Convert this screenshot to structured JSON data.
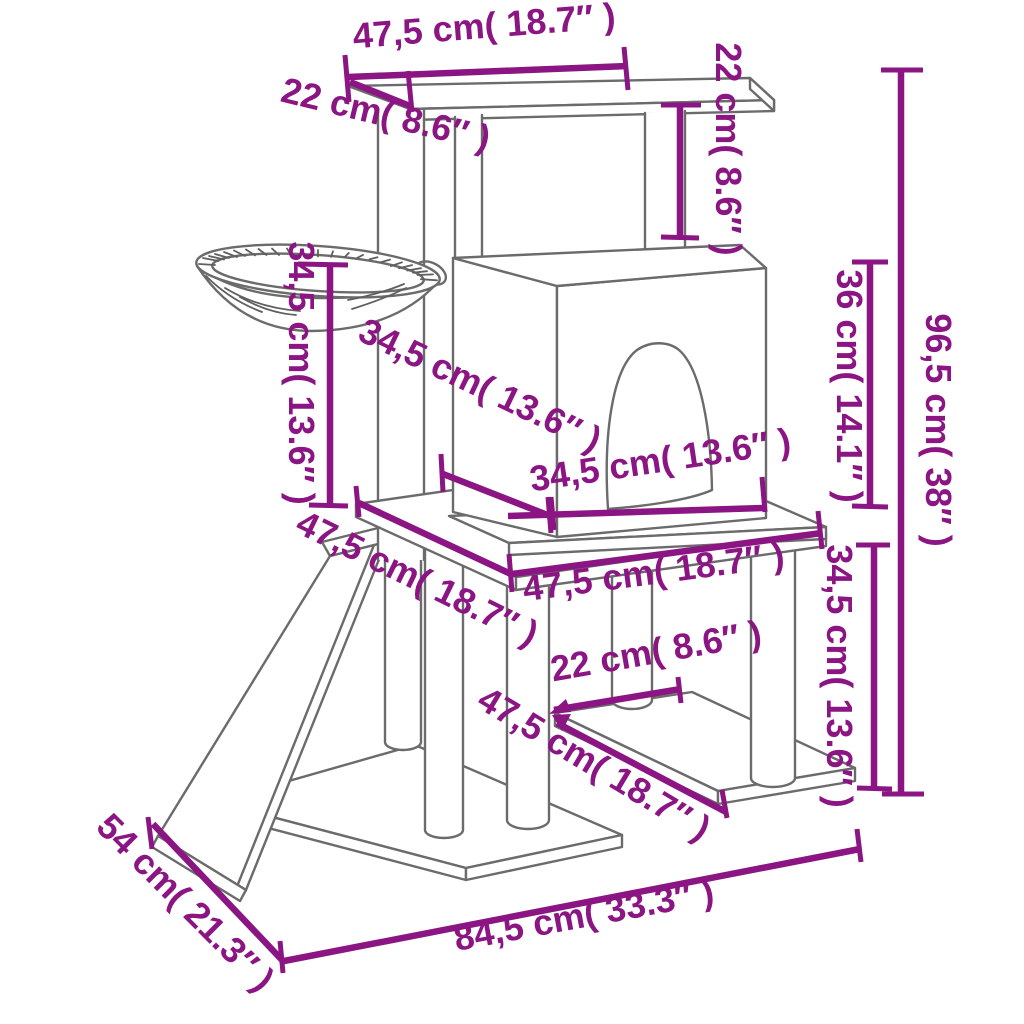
{
  "page": {
    "background": "#ffffff",
    "description": "Cat tree with scratching posts – dimension diagram"
  },
  "colors": {
    "dimension": "#8B1583",
    "outline": "#6B6B6B"
  },
  "units": {
    "primary": "cm",
    "secondary": "inch"
  },
  "dimensions": {
    "top_platform_width": {
      "cm": "47,5",
      "in": "18.7",
      "label": "47,5 cm( 18.7″ )"
    },
    "top_platform_depth": {
      "cm": "22",
      "in": "8.6",
      "label": "22 cm( 8.6″ )"
    },
    "top_to_house_roof": {
      "cm": "22",
      "in": "8.6",
      "label": "22 cm( 8.6″ )"
    },
    "total_height": {
      "cm": "96,5",
      "in": "38",
      "label": "96,5 cm( 38″ )"
    },
    "house_height": {
      "cm": "36",
      "in": "14.1",
      "label": "36 cm( 14.1″ )"
    },
    "lower_right_height": {
      "cm": "34,5",
      "in": "13.6",
      "label": "34,5 cm( 13.6″ )"
    },
    "basket_to_platform": {
      "cm": "34,5",
      "in": "13.6",
      "label": "34,5 cm( 13.6″ )"
    },
    "house_depth": {
      "cm": "34,5",
      "in": "13.6",
      "label": "34,5 cm( 13.6″ )"
    },
    "house_width": {
      "cm": "34,5",
      "in": "13.6",
      "label": "34,5 cm( 13.6″ )"
    },
    "mid_platform_width": {
      "cm": "47,5",
      "in": "18.7",
      "label": "47,5 cm( 18.7″ )"
    },
    "mid_platform_depth": {
      "cm": "47,5",
      "in": "18.7",
      "label": "47,5 cm( 18.7″ )"
    },
    "lower_shelf_width": {
      "cm": "22",
      "in": "8.6",
      "label": "22 cm( 8.6″ )"
    },
    "lower_shelf_depth": {
      "cm": "47,5",
      "in": "18.7",
      "label": "47,5 cm( 18.7″ )"
    },
    "base_depth": {
      "cm": "54",
      "in": "21.3",
      "label": "54 cm( 21.3″ )"
    },
    "base_width": {
      "cm": "84,5",
      "in": "33.3",
      "label": "84,5 cm( 33.3″ )"
    }
  }
}
